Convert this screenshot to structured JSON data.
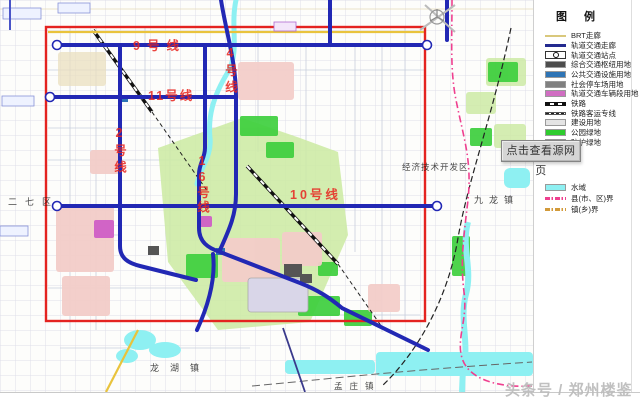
{
  "legend": {
    "title": "图 例",
    "items": [
      {
        "label": "BRT走廊",
        "type": "line-thin",
        "color": "#d9c87c"
      },
      {
        "label": "轨道交通走廊",
        "type": "line-thick",
        "color": "#232a8f"
      },
      {
        "label": "轨道交通站点",
        "type": "station",
        "color": "#ffffff"
      },
      {
        "label": "综合交通枢纽用地",
        "type": "box",
        "color": "#4d4d4d"
      },
      {
        "label": "公共交通设施用地",
        "type": "box",
        "color": "#2e74b5"
      },
      {
        "label": "社会停车场用地",
        "type": "box",
        "color": "#808080"
      },
      {
        "label": "轨道交通车辆段用地",
        "type": "box",
        "color": "#d06ec2"
      },
      {
        "label": "铁路",
        "type": "railway",
        "color": "#111111"
      },
      {
        "label": "铁路客运专线",
        "type": "railway-fine",
        "color": "#333333"
      },
      {
        "label": "建设用地",
        "type": "box",
        "color": "#e4e4e4"
      },
      {
        "label": "公园绿地",
        "type": "box",
        "color": "#2ecc2e"
      },
      {
        "label": "防护绿地",
        "type": "box",
        "color": "#a6e7a0"
      },
      {
        "label": "水域",
        "type": "box",
        "color": "#8ef0f2"
      },
      {
        "label": "县(市、区)界",
        "type": "boundary",
        "color": "#ef3f8f"
      },
      {
        "label": "镇(乡)界",
        "type": "boundary",
        "color": "#d29a3a"
      }
    ]
  },
  "tooltip": {
    "text": "点击查看源网页"
  },
  "watermark": {
    "text": "头条号 / 郑州楼鉴"
  },
  "map": {
    "line_labels": [
      {
        "id": "line-9",
        "text": "9号线"
      },
      {
        "id": "line-4",
        "text": "4号线"
      },
      {
        "id": "line-11",
        "text": "11号线"
      },
      {
        "id": "line-2",
        "text": "2号线"
      },
      {
        "id": "line-16",
        "text": "16号线"
      },
      {
        "id": "line-10",
        "text": "10号线"
      }
    ],
    "place_labels": [
      {
        "id": "erqi",
        "text": "二七区"
      },
      {
        "id": "jingji",
        "text": "经济技术开发区"
      },
      {
        "id": "jiulong",
        "text": "九龙镇"
      },
      {
        "id": "longhu",
        "text": "龙湖镇"
      },
      {
        "id": "mengzhuang",
        "text": "孟庄镇"
      }
    ],
    "colors": {
      "metro": "#2228b4",
      "planning_boundary": "#e42320",
      "line_label": "#e8251f",
      "water": "#8ef0f2",
      "park_green": "#3ecf3e",
      "brt": "#e9c33c",
      "county_boundary": "#ef3f8f"
    }
  }
}
